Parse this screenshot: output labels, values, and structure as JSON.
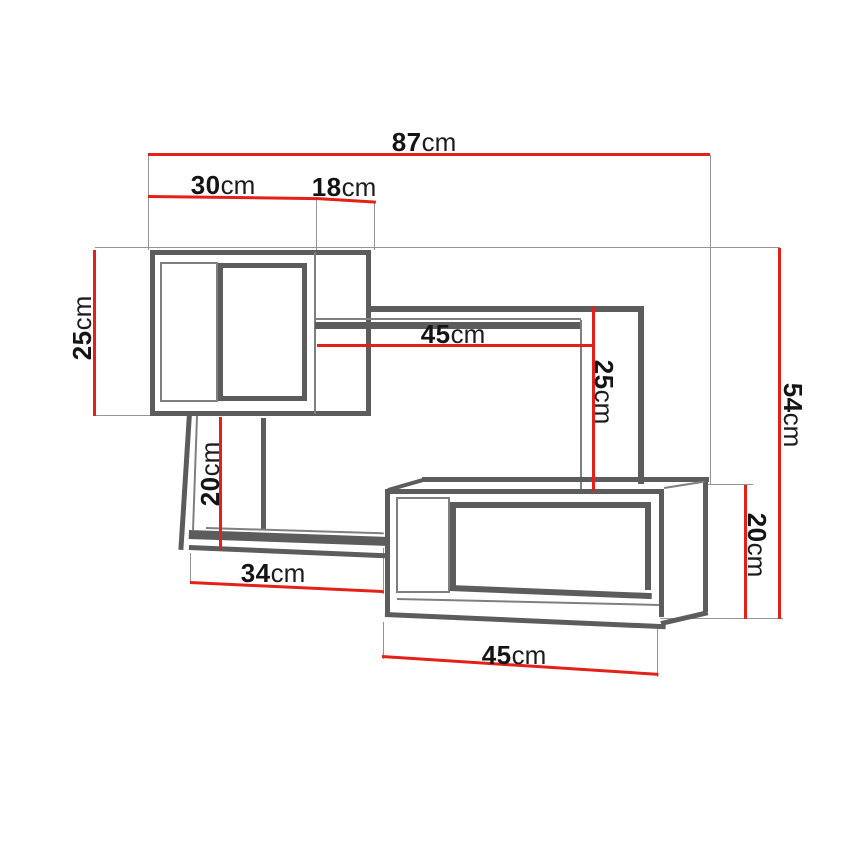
{
  "drawing": {
    "type": "furniture dimension diagram",
    "subject": "wall-mounted shelf unit, three linked shelf boxes with dimension lines",
    "unit": "cm",
    "colors": {
      "dimension_line": "#e32119",
      "structure": "#5c5c5c",
      "structure_light": "#7f7f7f",
      "extension_line": "#949494",
      "text": "#141414",
      "background": "#ffffff"
    }
  },
  "dims": {
    "total_width": {
      "num": "87",
      "unit": "cm"
    },
    "cube_width": {
      "num": "30",
      "unit": "cm"
    },
    "cube_depth": {
      "num": "18",
      "unit": "cm"
    },
    "cube_height": {
      "num": "25",
      "unit": "cm"
    },
    "mid_shelf_length": {
      "num": "45",
      "unit": "cm"
    },
    "mid_panel_drop": {
      "num": "25",
      "unit": "cm"
    },
    "total_height": {
      "num": "54",
      "unit": "cm"
    },
    "left_panel_drop": {
      "num": "20",
      "unit": "cm"
    },
    "bottom_shelf_length": {
      "num": "34",
      "unit": "cm"
    },
    "box_height": {
      "num": "20",
      "unit": "cm"
    },
    "box_width": {
      "num": "45",
      "unit": "cm"
    }
  }
}
